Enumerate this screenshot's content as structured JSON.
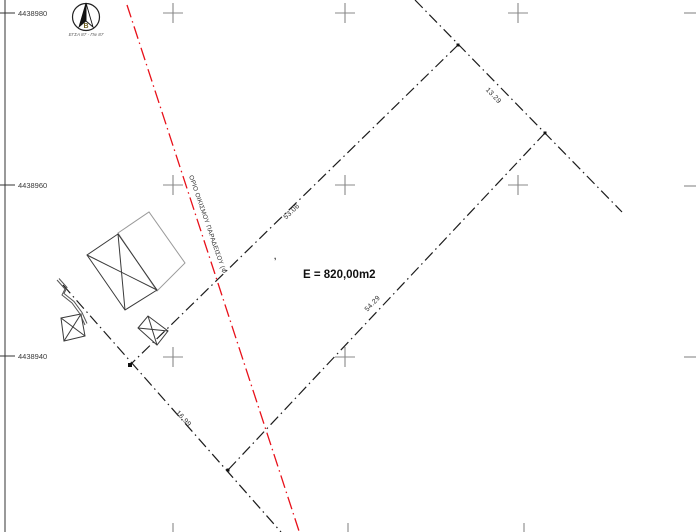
{
  "drawing": {
    "north_arrow": {
      "north_letter": "Β",
      "datum_label": "ΕΓΣΑ 87 - Πιν 87"
    },
    "grid": {
      "labels": [
        "4438980",
        "4438960",
        "4438940"
      ]
    },
    "parcel": {
      "area_label": "E = 820,00m2",
      "dimensions": {
        "northwest_side": "53.06",
        "northeast_side": "13.29",
        "southeast_side": "54.29",
        "southwest_side": "16.99"
      }
    },
    "settlement_boundary_label": "ΟΡΙΟ ΟΙΚΙΣΜΟΥ ΠΑΡΑΔΕΙΣΟΥ (Φ",
    "point_mark": ","
  },
  "colors": {
    "settlement_boundary": "#e8111a",
    "parcel_boundary": "#1c1c1c",
    "grid_cross": "#888888",
    "building_outline": "#3a3a3a",
    "proposed_outline": "#9a9a9a"
  }
}
